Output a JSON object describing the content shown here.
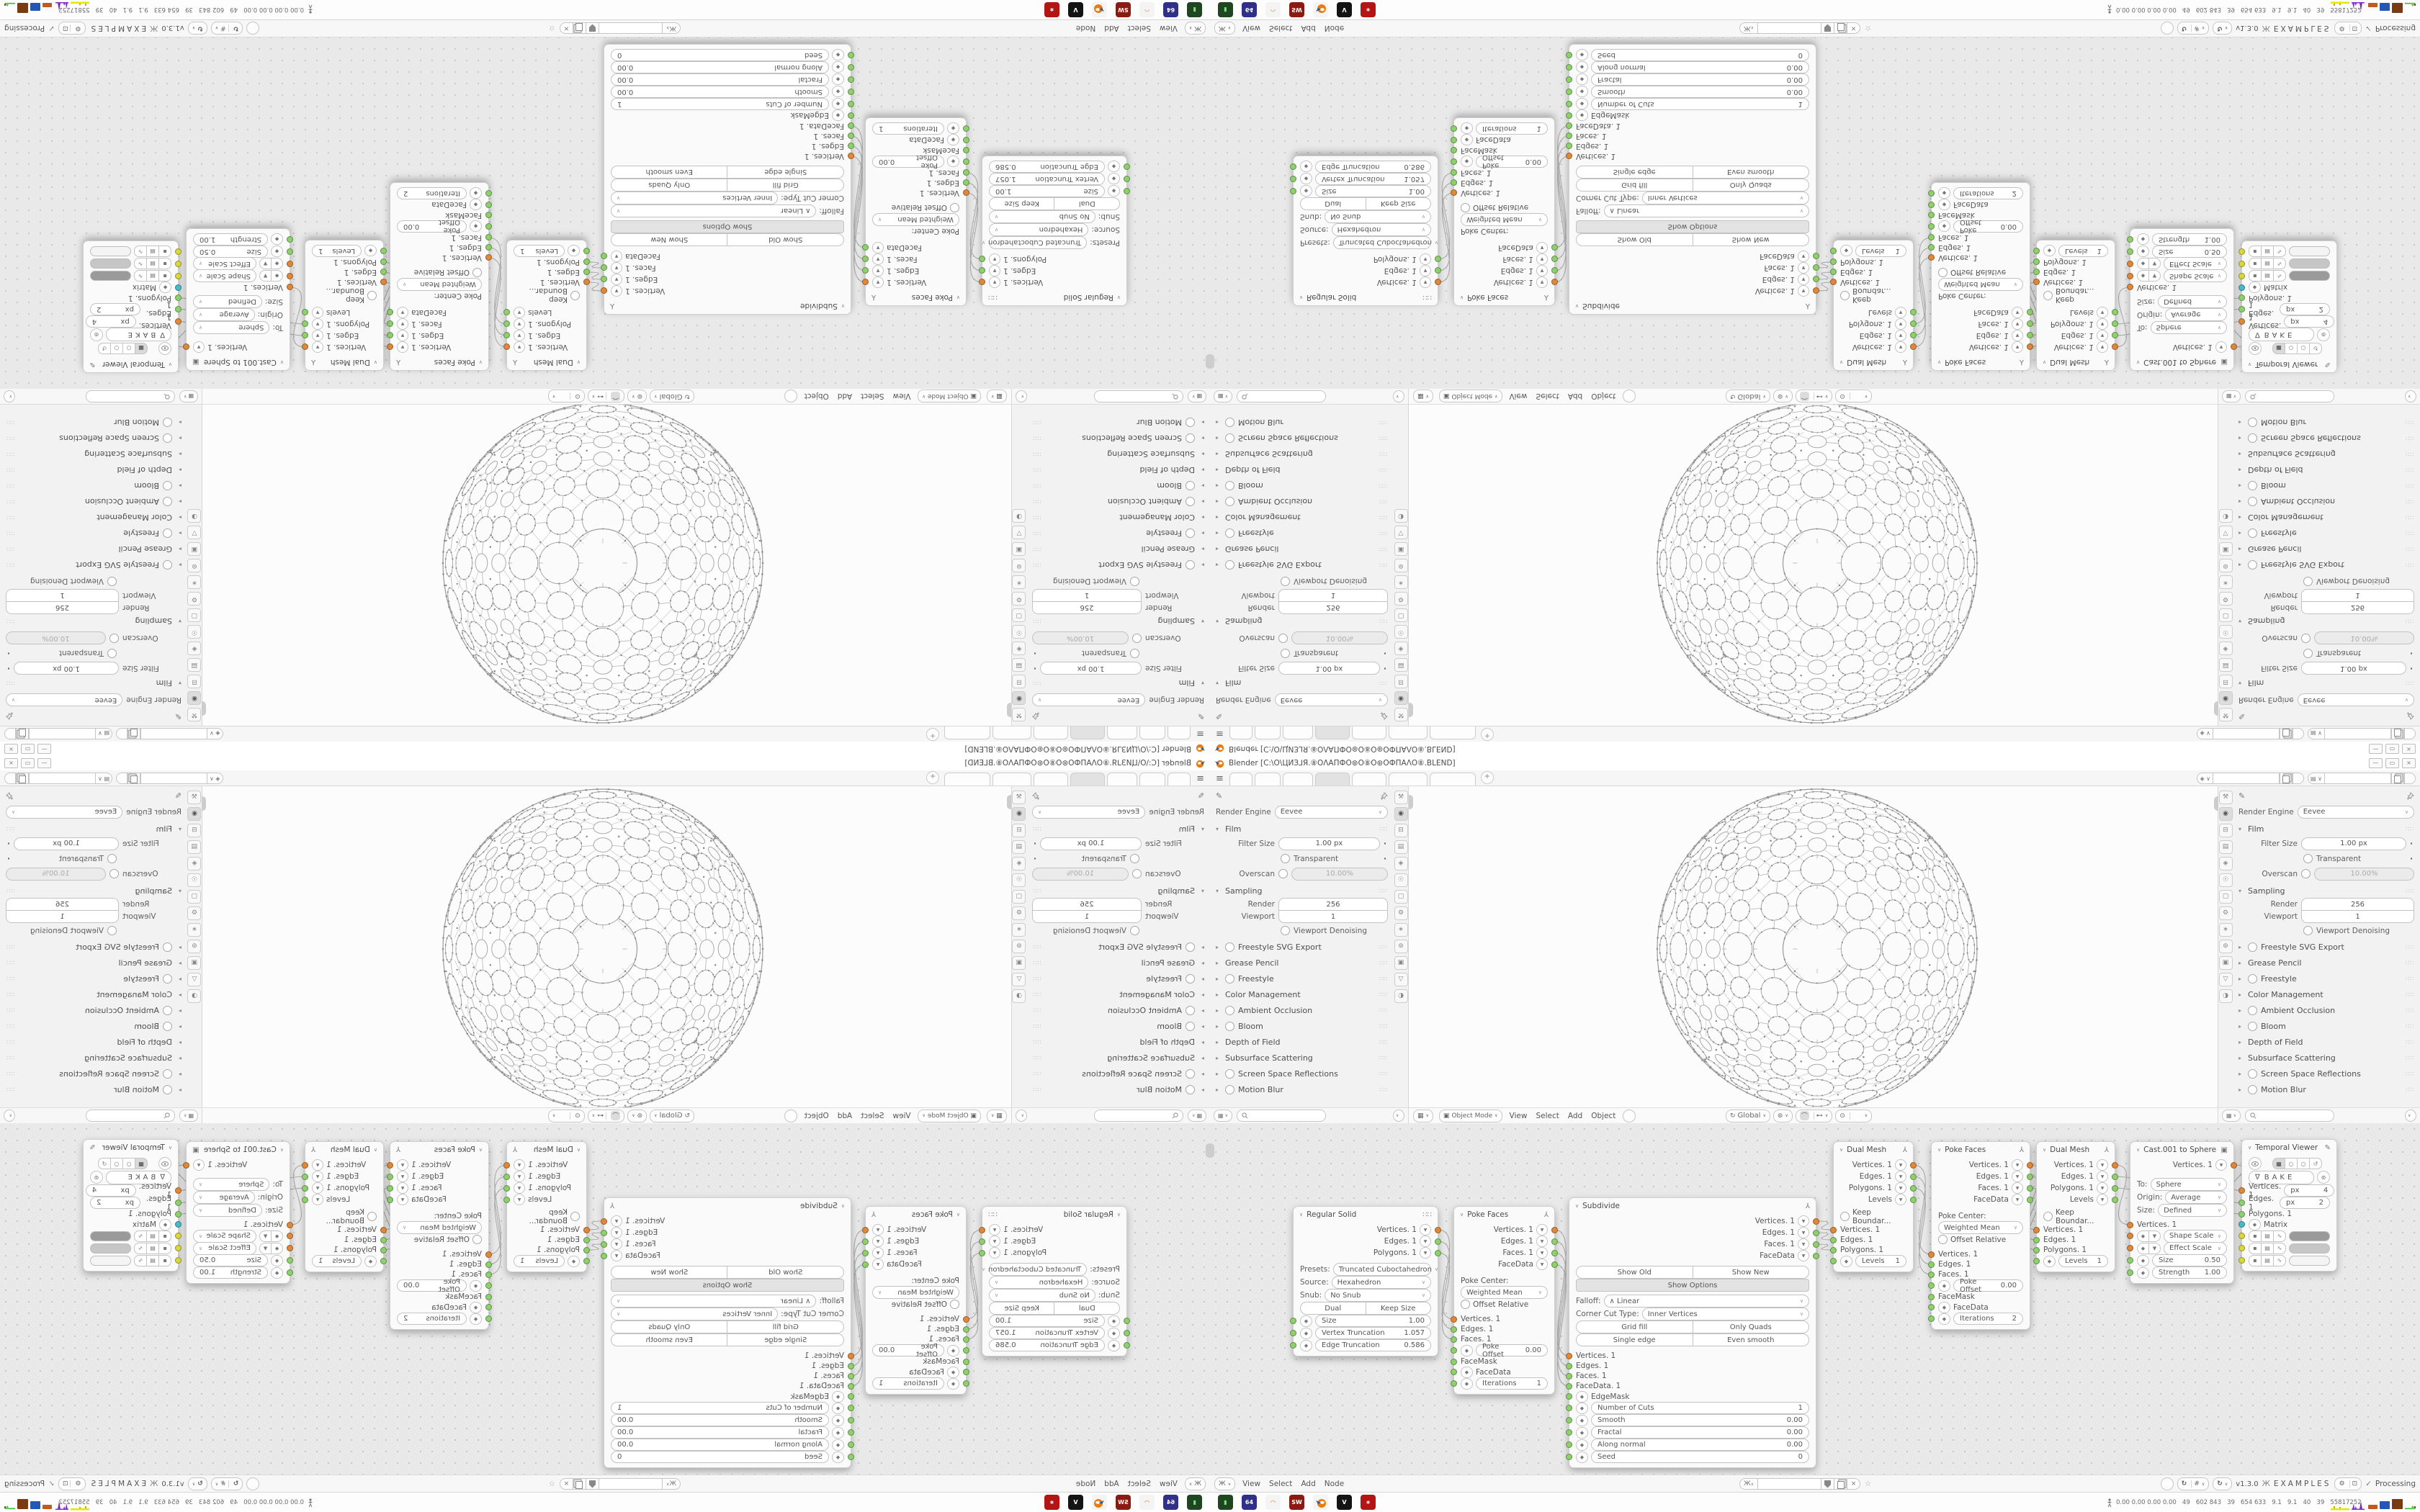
{
  "window": {
    "app_title": "Blender [C:\\O\\ЦИЗ⅃Я.⑧ОΛАПФО⊛О⑧О⊛ОФПАΛО⑧.BLEND]",
    "controls": [
      "minimize",
      "maximize",
      "close"
    ]
  },
  "tabs": {
    "items": [
      "",
      "",
      "",
      "",
      "",
      "",
      ""
    ],
    "active_index": 3,
    "add_label": "+"
  },
  "id_selectors": {
    "scene_value": "",
    "viewlayer_value": ""
  },
  "properties": {
    "render_engine_label": "Render Engine",
    "render_engine_value": "Eevee",
    "film_title": "Film",
    "filter_size_label": "Filter Size",
    "filter_size_value": "1.00 px",
    "transparent_label": "Transparent",
    "overscan_label": "Overscan",
    "overscan_value": "10.00%",
    "sampling_title": "Sampling",
    "render_label": "Render",
    "render_value": "256",
    "viewport_label": "Viewport",
    "viewport_value": "1",
    "denoising_label": "Viewport Denoising",
    "collapsed_sections": [
      {
        "label": "Freestyle SVG Export",
        "has_toggle": true
      },
      {
        "label": "Grease Pencil",
        "has_toggle": false
      },
      {
        "label": "Freestyle",
        "has_toggle": true
      },
      {
        "label": "Color Management",
        "has_toggle": false
      },
      {
        "label": "Ambient Occlusion",
        "has_toggle": true
      },
      {
        "label": "Bloom",
        "has_toggle": true
      },
      {
        "label": "Depth of Field",
        "has_toggle": false
      },
      {
        "label": "Subsurface Scattering",
        "has_toggle": false
      },
      {
        "label": "Screen Space Reflections",
        "has_toggle": true
      },
      {
        "label": "Motion Blur",
        "has_toggle": true
      }
    ],
    "tab_icons": [
      {
        "name": "tool-tab-icon",
        "glyph": "⚒"
      },
      {
        "name": "render-tab-icon",
        "glyph": "◉"
      },
      {
        "name": "output-tab-icon",
        "glyph": "⊟"
      },
      {
        "name": "view-layer-tab-icon",
        "glyph": "▤"
      },
      {
        "name": "scene-tab-icon",
        "glyph": "◈"
      },
      {
        "name": "world-tab-icon",
        "glyph": "☉"
      },
      {
        "name": "object-tab-icon",
        "glyph": "▢"
      },
      {
        "name": "modifiers-tab-icon",
        "glyph": "⚙"
      },
      {
        "name": "particles-tab-icon",
        "glyph": "∗"
      },
      {
        "name": "physics-tab-icon",
        "glyph": "⊚"
      },
      {
        "name": "constraints-tab-icon",
        "glyph": "▣"
      },
      {
        "name": "data-tab-icon",
        "glyph": "▽"
      },
      {
        "name": "material-tab-icon",
        "glyph": "◑"
      }
    ]
  },
  "viewport": {
    "mode_value": "Object Mode",
    "menus": [
      "View",
      "Select",
      "Add",
      "Object"
    ],
    "orientation_value": "Global"
  },
  "node_editor": {
    "menus": [
      "View",
      "Select",
      "Add",
      "Node"
    ],
    "tree_name_value": "",
    "version_label": "v1.3.0",
    "tree_label": "EXAMPLES",
    "processing_label": "Processing",
    "socket_colors": {
      "o": "#e0883a",
      "g": "#8ed06c",
      "c": "#49b8c8",
      "y": "#d8d83c"
    },
    "nodes": [
      {
        "title": "Regular Solid",
        "header_icon": "dots",
        "rows": [
          {
            "t": "out",
            "label": "Vertices. 1",
            "s": "o"
          },
          {
            "t": "out",
            "label": "Edges. 1",
            "s": "g"
          },
          {
            "t": "out",
            "label": "Polygons. 1",
            "s": "g"
          },
          {
            "t": "space",
            "h": 6
          },
          {
            "t": "sel2",
            "prefix": "Presets:",
            "label": "Truncated Cuboctahedron"
          },
          {
            "t": "sel2",
            "prefix": "Source:",
            "label": "Hexahedron"
          },
          {
            "t": "sel2",
            "prefix": "Snub:",
            "label": "No Snub"
          },
          {
            "t": "btn2",
            "a": "Dual",
            "b": "Keep Size"
          },
          {
            "t": "field",
            "label": "Size",
            "value": "1.00",
            "s": "g"
          },
          {
            "t": "field",
            "label": "Vertex Truncation",
            "value": "1.057",
            "s": "g"
          },
          {
            "t": "field",
            "label": "Edge Truncation",
            "value": "0.586",
            "s": "g"
          }
        ]
      },
      {
        "title": "Poke Faces",
        "header_icon": "foot",
        "rows": [
          {
            "t": "out",
            "label": "Vertices. 1",
            "s": "o"
          },
          {
            "t": "out",
            "label": "Edges. 1",
            "s": "g"
          },
          {
            "t": "out",
            "label": "Faces. 1",
            "s": "g"
          },
          {
            "t": "out",
            "label": "FaceData",
            "s": "g"
          },
          {
            "t": "space",
            "h": 8
          },
          {
            "t": "lbl",
            "label": "Poke Center:"
          },
          {
            "t": "sel",
            "label": "Weighted Mean"
          },
          {
            "t": "toggle",
            "label": "Offset Relative"
          },
          {
            "t": "space",
            "h": 6
          },
          {
            "t": "in",
            "label": "Vertices. 1",
            "s": "o"
          },
          {
            "t": "in",
            "label": "Edges. 1",
            "s": "g"
          },
          {
            "t": "in",
            "label": "Faces. 1",
            "s": "g"
          },
          {
            "t": "field",
            "label": "Poke Offset",
            "value": "0.00",
            "s": "g"
          },
          {
            "t": "in",
            "label": "FaceMask",
            "s": "g"
          },
          {
            "t": "inx",
            "label": "FaceData",
            "s": "g"
          },
          {
            "t": "field",
            "label": "Iterations",
            "value": "1",
            "s": "g"
          }
        ]
      },
      {
        "title": "Subdivide",
        "header_icon": "foot",
        "rows": [
          {
            "t": "out",
            "label": "Vertices. 1",
            "s": "o"
          },
          {
            "t": "out",
            "label": "Edges. 1",
            "s": "g"
          },
          {
            "t": "out",
            "label": "Faces. 1",
            "s": "g"
          },
          {
            "t": "out",
            "label": "FaceData",
            "s": "g"
          },
          {
            "t": "space",
            "h": 6
          },
          {
            "t": "btn2",
            "a": "Show Old",
            "b": "Show New"
          },
          {
            "t": "btn1",
            "label": "Show Options",
            "pressed": true
          },
          {
            "t": "space",
            "h": 4
          },
          {
            "t": "sel2",
            "prefix": "Falloff:",
            "label": "∧ Linear"
          },
          {
            "t": "sel2",
            "prefix": "Corner Cut Type:",
            "label": "Inner Vertices"
          },
          {
            "t": "btn2",
            "a": "Grid fill",
            "b": "Only Quads"
          },
          {
            "t": "btn2",
            "a": "Single edge",
            "b": "Even smooth"
          },
          {
            "t": "space",
            "h": 6
          },
          {
            "t": "in",
            "label": "Vertices. 1",
            "s": "o"
          },
          {
            "t": "in",
            "label": "Edges. 1",
            "s": "g"
          },
          {
            "t": "in",
            "label": "Faces. 1",
            "s": "g"
          },
          {
            "t": "in",
            "label": "FaceData. 1",
            "s": "g"
          },
          {
            "t": "inx",
            "label": "EdgeMask",
            "s": "g"
          },
          {
            "t": "field",
            "label": "Number of Cuts",
            "value": "1",
            "s": "g"
          },
          {
            "t": "field",
            "label": "Smooth",
            "value": "0.00",
            "s": "g"
          },
          {
            "t": "field",
            "label": "Fractal",
            "value": "0.00",
            "s": "g"
          },
          {
            "t": "field",
            "label": "Along normal",
            "value": "0.00",
            "s": "g"
          },
          {
            "t": "field",
            "label": "Seed",
            "value": "0",
            "s": "g"
          }
        ]
      },
      {
        "title": "Dual Mesh",
        "header_icon": "foot",
        "rows": [
          {
            "t": "out",
            "label": "Vertices. 1",
            "s": "o"
          },
          {
            "t": "out",
            "label": "Edges. 1",
            "s": "g"
          },
          {
            "t": "out",
            "label": "Polygons. 1",
            "s": "g"
          },
          {
            "t": "out",
            "label": "Levels",
            "s": "g"
          },
          {
            "t": "space",
            "h": 8
          },
          {
            "t": "toggle",
            "label": "Keep Boundar..."
          },
          {
            "t": "space",
            "h": 4
          },
          {
            "t": "in",
            "label": "Vertices. 1",
            "s": "o"
          },
          {
            "t": "in",
            "label": "Edges. 1",
            "s": "g"
          },
          {
            "t": "in",
            "label": "Polygons. 1",
            "s": "g"
          },
          {
            "t": "field",
            "label": "Levels",
            "value": "1",
            "s": "g"
          }
        ]
      },
      {
        "title": "Poke Faces",
        "header_icon": "foot",
        "rows": [
          {
            "t": "out",
            "label": "Vertices. 1",
            "s": "o"
          },
          {
            "t": "out",
            "label": "Edges. 1",
            "s": "g"
          },
          {
            "t": "out",
            "label": "Faces. 1",
            "s": "g"
          },
          {
            "t": "out",
            "label": "FaceData",
            "s": "g"
          },
          {
            "t": "space",
            "h": 8
          },
          {
            "t": "lbl",
            "label": "Poke Center:"
          },
          {
            "t": "sel",
            "label": "Weighted Mean"
          },
          {
            "t": "toggle",
            "label": "Offset Relative"
          },
          {
            "t": "space",
            "h": 6
          },
          {
            "t": "in",
            "label": "Vertices. 1",
            "s": "o"
          },
          {
            "t": "in",
            "label": "Edges. 1",
            "s": "g"
          },
          {
            "t": "in",
            "label": "Faces. 1",
            "s": "g"
          },
          {
            "t": "field",
            "label": "Poke Offset",
            "value": "0.00",
            "s": "g"
          },
          {
            "t": "in",
            "label": "FaceMask",
            "s": "g"
          },
          {
            "t": "inx",
            "label": "FaceData",
            "s": "g"
          },
          {
            "t": "field",
            "label": "Iterations",
            "value": "2",
            "s": "g"
          }
        ]
      },
      {
        "title": "Dual Mesh",
        "header_icon": "foot",
        "rows": [
          {
            "t": "out",
            "label": "Vertices. 1",
            "s": "o"
          },
          {
            "t": "out",
            "label": "Edges. 1",
            "s": "g"
          },
          {
            "t": "out",
            "label": "Polygons. 1",
            "s": "g"
          },
          {
            "t": "out",
            "label": "Levels",
            "s": "g"
          },
          {
            "t": "space",
            "h": 8
          },
          {
            "t": "toggle",
            "label": "Keep Boundar..."
          },
          {
            "t": "space",
            "h": 4
          },
          {
            "t": "in",
            "label": "Vertices. 1",
            "s": "o"
          },
          {
            "t": "in",
            "label": "Edges. 1",
            "s": "g"
          },
          {
            "t": "in",
            "label": "Polygons. 1",
            "s": "g"
          },
          {
            "t": "field",
            "label": "Levels",
            "value": "1",
            "s": "g"
          }
        ]
      },
      {
        "title": "Cast.001 to Sphere",
        "header_icon": "note",
        "rows": [
          {
            "t": "out",
            "label": "Vertices. 1",
            "s": "o"
          },
          {
            "t": "space",
            "h": 10
          },
          {
            "t": "sel2",
            "prefix": "To:",
            "label": "Sphere"
          },
          {
            "t": "sel2",
            "prefix": "Origin:",
            "label": "Average"
          },
          {
            "t": "sel2",
            "prefix": "Size:",
            "label": "Defined"
          },
          {
            "t": "space",
            "h": 4
          },
          {
            "t": "in",
            "label": "Vertices. 1",
            "s": "o"
          },
          {
            "t": "combo",
            "label": "Shape Scale",
            "s": "o"
          },
          {
            "t": "combo",
            "label": "Effect Scale",
            "s": "o"
          },
          {
            "t": "field",
            "label": "Size",
            "value": "0.50",
            "s": "g"
          },
          {
            "t": "field",
            "label": "Strength",
            "value": "1.00",
            "s": "g"
          }
        ]
      },
      {
        "title": "Temporal Viewer",
        "header_icon": "pencil",
        "rows": [
          {
            "t": "iconrow"
          },
          {
            "t": "bake",
            "label": "BAKE"
          },
          {
            "t": "pxfield",
            "label": "Vertices. 1",
            "unit": "px",
            "value": "4",
            "s": "o"
          },
          {
            "t": "pxfield",
            "label": "Edges. 1",
            "unit": "px",
            "value": "2",
            "s": "g"
          },
          {
            "t": "in",
            "label": "Polygons. 1",
            "s": "g"
          },
          {
            "t": "inx",
            "label": "Matrix",
            "s": "c"
          },
          {
            "t": "swatch",
            "shade": "#9a9a9a",
            "s": "y"
          },
          {
            "t": "swatch",
            "shade": "#c6c6c6",
            "s": "y"
          },
          {
            "t": "swatch",
            "shade": "#f4f4f4",
            "s": "y"
          }
        ]
      }
    ]
  },
  "status_bar": {
    "stats_text": "0.00 0.00 0.00 0.00   49   602 843   39   654 633   9.1   9.1   40   39   55817252"
  },
  "taskbar": {
    "icons": [
      {
        "name": "console-app-icon",
        "glyph": "▮",
        "bg": "#1e4620",
        "fg": "#7ee07e"
      },
      {
        "name": "c64-app-icon",
        "glyph": "64",
        "bg": "#30308a",
        "fg": "#ffffff"
      },
      {
        "name": "firefox-app-icon",
        "glyph": "◠",
        "bg": "#f4f4f4",
        "fg": "#e8641a"
      },
      {
        "name": "sw-app-icon",
        "glyph": "SW",
        "bg": "#8c1a10",
        "fg": "#ffffff"
      },
      {
        "name": "blender-app-icon",
        "glyph": "",
        "bg": "#f4f4f4",
        "fg": "#e87d0d"
      },
      {
        "name": "inkscape-app-icon",
        "glyph": "V",
        "bg": "#141414",
        "fg": "#ffffff"
      },
      {
        "name": "suite-app-icon",
        "glyph": "∗",
        "bg": "#b31515",
        "fg": "#ffffff"
      }
    ]
  }
}
